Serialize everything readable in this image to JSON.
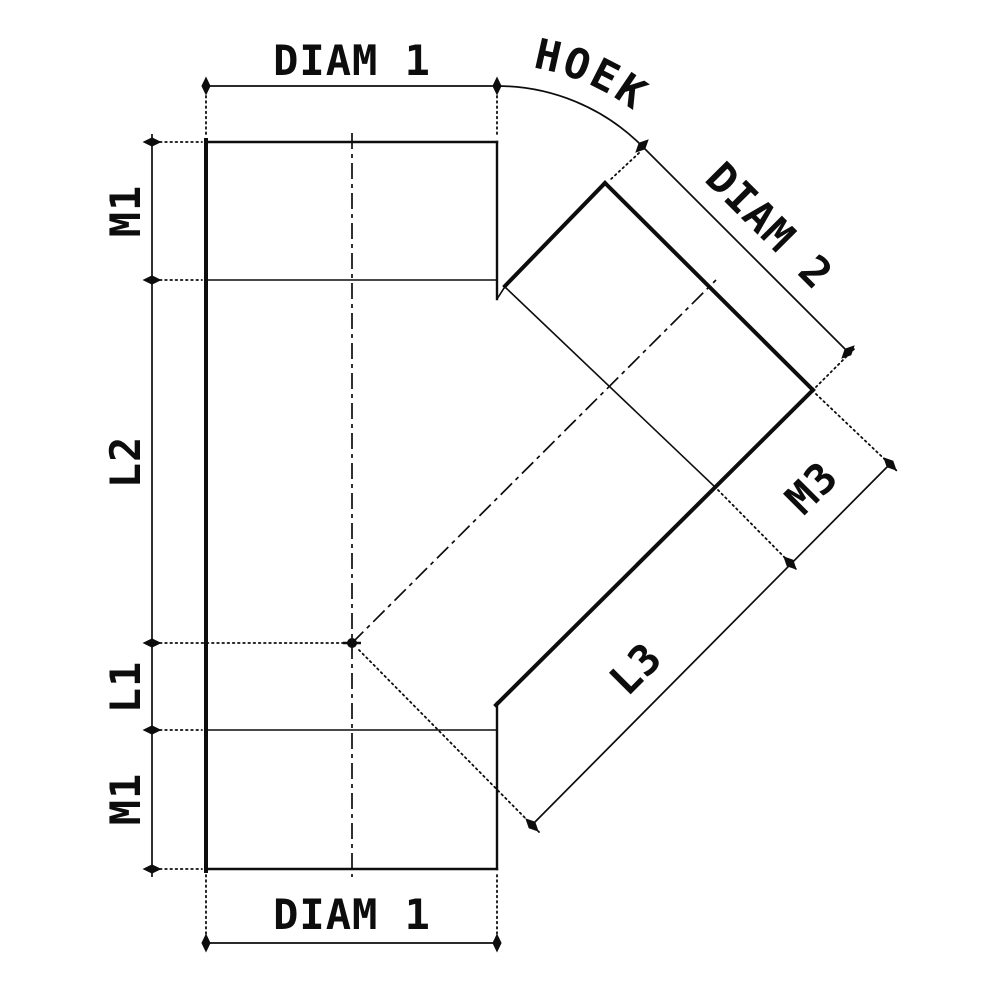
{
  "drawing": {
    "background_color": "#ffffff",
    "line_color": "#0d0d0d",
    "labels": {
      "diam1_top": "DIAM 1",
      "hoek": "HOEK",
      "diam2": "DIAM 2",
      "m1_top": "M1",
      "l2": "L2",
      "l1": "L1",
      "m1_bottom": "M1",
      "l3": "L3",
      "m3": "M3",
      "diam1_bottom": "DIAM 1"
    }
  }
}
